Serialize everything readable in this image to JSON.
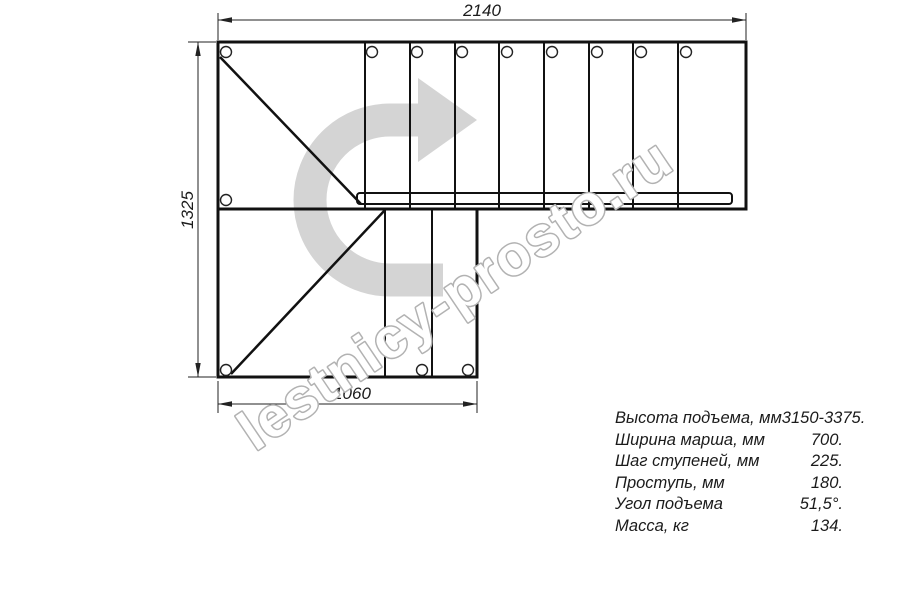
{
  "drawing": {
    "dim_top": "2140",
    "dim_left": "1325",
    "dim_bottom": "1060"
  },
  "arrow": {
    "color": "#d4d4d4"
  },
  "watermark": {
    "text": "lestnicy-prosto.ru",
    "color": "#b2b2b2"
  },
  "specs": {
    "rows": [
      {
        "label": "Высота подъема, мм",
        "value": "3150-3375."
      },
      {
        "label": "Ширина марша, мм",
        "value": "700."
      },
      {
        "label": "Шаг ступеней, мм",
        "value": "225."
      },
      {
        "label": "Проступь, мм",
        "value": "180."
      },
      {
        "label": "Угол подъема",
        "value": "51,5°."
      },
      {
        "label": "Масса, кг",
        "value": "134."
      }
    ]
  }
}
